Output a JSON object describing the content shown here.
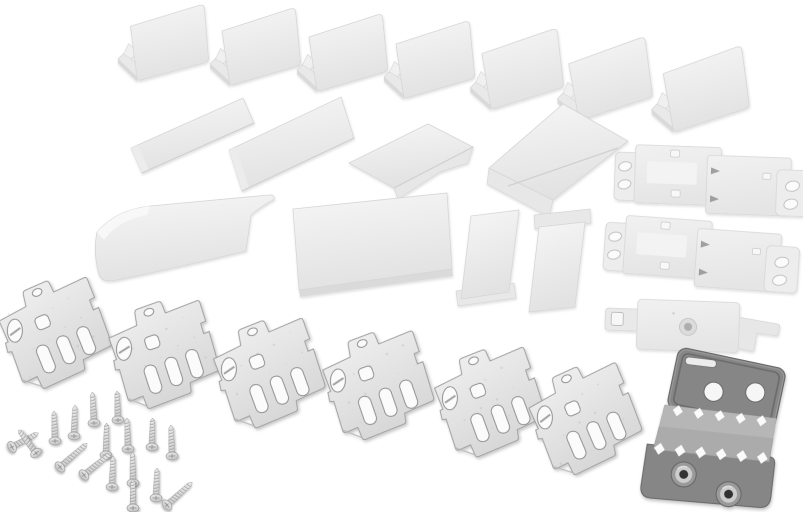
{
  "meta": {
    "title": "Appliance fixing kit parts",
    "description": "Product photograph on white background: seven white plastic corner cover caps, two flat cover strips, two wedge covers, one curved cover strip, one large cover plate, two small cover strips, two white plastic slide-bracket pairs, one white plastic slide plate, six galvanized steel slotted mounting brackets, one dark steel toothed bracket with two eyelets, and seventeen countersunk screws.",
    "background": "#ffffff",
    "width": 803,
    "height": 512
  },
  "palette": {
    "background": "#ffffff",
    "plastic_hi": "#f6f6f6",
    "plastic_lo": "#e2e2e2",
    "plastic_edge": "#d6d6d6",
    "plastic_shade": "#dadada",
    "plastic_panel": "#f3f3f3",
    "metal_hi": "#f0f0f0",
    "metal_lo": "#d8d8d8",
    "metal_edge": "#9f9f9f",
    "metal_speck": "#c2c2c2",
    "hole_fill": "#fbfbfb",
    "hole_edge": "#8d8d8d",
    "clip_mark": "#909090",
    "dark_plate": "#868686",
    "dark_edge": "#666666",
    "dark_inner": "#6b6b6b",
    "dark_band": "#ababab",
    "dark_band_hi": "#b6b6b6",
    "tooth": "#fbfbfb",
    "eyelet_outer": "#9a9a9a",
    "eyelet_ring": "#cdcdcd",
    "eyelet_hole": "#303030",
    "screw_hi": "#ececec",
    "screw_lo": "#c6c6c6",
    "screw_edge": "#9a9a9a",
    "screw_thread": "#a8a8a8"
  },
  "counts": {
    "corner_covers": 7,
    "flat_strip_covers": 2,
    "wedge_covers": 2,
    "curved_cover_strip": 1,
    "large_cover_plate": 1,
    "small_cover_strips": 2,
    "plastic_bracket_pairs": 2,
    "plastic_slide_plate": 1,
    "steel_slotted_brackets": 6,
    "toothed_bracket": 1,
    "screws": 17
  },
  "scene": {
    "corner_covers": [
      [
        116,
        -2,
        1,
        1
      ],
      [
        207,
        3,
        0,
        1
      ],
      [
        294,
        9,
        0,
        1
      ],
      [
        381,
        16,
        0,
        1
      ],
      [
        466,
        25,
        -1,
        1.03
      ],
      [
        552,
        35,
        -2,
        1.05
      ],
      [
        646,
        44,
        -2,
        1.08
      ]
    ],
    "flat_strips": [
      {
        "pts": [
          [
            131,
            148
          ],
          [
            243,
            98
          ],
          [
            254,
            123
          ],
          [
            142,
            173
          ]
        ]
      },
      {
        "pts": [
          [
            229,
            150
          ],
          [
            341,
            97
          ],
          [
            354,
            138
          ],
          [
            242,
            191
          ]
        ]
      }
    ],
    "wedge_covers": [
      {
        "face": [
          [
            349,
            163
          ],
          [
            428,
            124
          ],
          [
            473,
            147
          ],
          [
            394,
            188
          ]
        ],
        "flap": [
          [
            394,
            188
          ],
          [
            473,
            147
          ],
          [
            468,
            163
          ],
          [
            440,
            172
          ],
          [
            398,
            199
          ]
        ],
        "ridge": [
          394,
          188,
          473,
          147
        ]
      },
      {
        "face": [
          [
            489,
            168
          ],
          [
            563,
            104
          ],
          [
            628,
            141
          ],
          [
            553,
            200
          ]
        ],
        "flap": [
          [
            489,
            168
          ],
          [
            553,
            200
          ],
          [
            549,
            217
          ],
          [
            487,
            184
          ]
        ],
        "ridge": [
          508,
          186,
          618,
          148
        ]
      }
    ],
    "curved_strip": {
      "d": "M97,232 Q116,210 150,206 L269,195 Q275,194.5 274,199.5 Q260,207 251,215 L246,251 Q176,268 117,280 Q101,283.5 98.5,273 Q93,252 97,232 Z",
      "fold": "M97,232 Q116,210 150,206 L147,215 Q118,220 104,240 Z"
    },
    "large_plate": {
      "quad": [
        [
          293,
          209
        ],
        [
          447,
          193
        ],
        [
          452,
          269
        ],
        [
          299,
          290
        ]
      ],
      "edge": [
        [
          299,
          290
        ],
        [
          452,
          269
        ],
        [
          453,
          276
        ],
        [
          300,
          297
        ]
      ]
    },
    "small_strips": [
      {
        "foot": [
          [
            456,
            291
          ],
          [
            514,
            283
          ],
          [
            516,
            298
          ],
          [
            458,
            306
          ]
        ],
        "body": [
          [
            471,
            216
          ],
          [
            519,
            210
          ],
          [
            509,
            292
          ],
          [
            461,
            299
          ]
        ]
      },
      {
        "foot": [
          [
            534,
            215
          ],
          [
            590,
            209
          ],
          [
            591,
            223
          ],
          [
            535,
            229
          ]
        ],
        "body": [
          [
            539,
            227
          ],
          [
            585,
            222
          ],
          [
            575,
            307
          ],
          [
            529,
            312
          ]
        ]
      }
    ],
    "bracket_pairs": [
      [
        616,
        140,
        2
      ],
      [
        607,
        210,
        4
      ]
    ],
    "single_plate": [
      606,
      298,
      2
    ],
    "metal_brackets": [
      [
        56,
        331,
        -18
      ],
      [
        165,
        352,
        -14
      ],
      [
        270,
        371,
        -16
      ],
      [
        379,
        383,
        -15
      ],
      [
        491,
        400,
        -16
      ],
      [
        586,
        417,
        -19
      ]
    ],
    "dark_bracket": [
      648,
      356,
      12
    ],
    "screws": [
      [
        12,
        447,
        62,
        30
      ],
      [
        36,
        453,
        -37,
        29
      ],
      [
        55,
        441,
        -2,
        30
      ],
      [
        74,
        436,
        2,
        31
      ],
      [
        94,
        423,
        -3,
        31
      ],
      [
        60,
        467,
        49,
        36
      ],
      [
        106,
        455,
        1,
        32
      ],
      [
        118,
        420,
        -2,
        29
      ],
      [
        128,
        449,
        -2,
        31
      ],
      [
        84,
        475,
        51,
        35
      ],
      [
        112,
        487,
        2,
        31
      ],
      [
        133,
        483,
        -1,
        31
      ],
      [
        152,
        447,
        1,
        29
      ],
      [
        133,
        508,
        0,
        29
      ],
      [
        156,
        498,
        2,
        30
      ],
      [
        172,
        456,
        -2,
        31
      ],
      [
        167,
        505,
        48,
        34
      ]
    ]
  }
}
